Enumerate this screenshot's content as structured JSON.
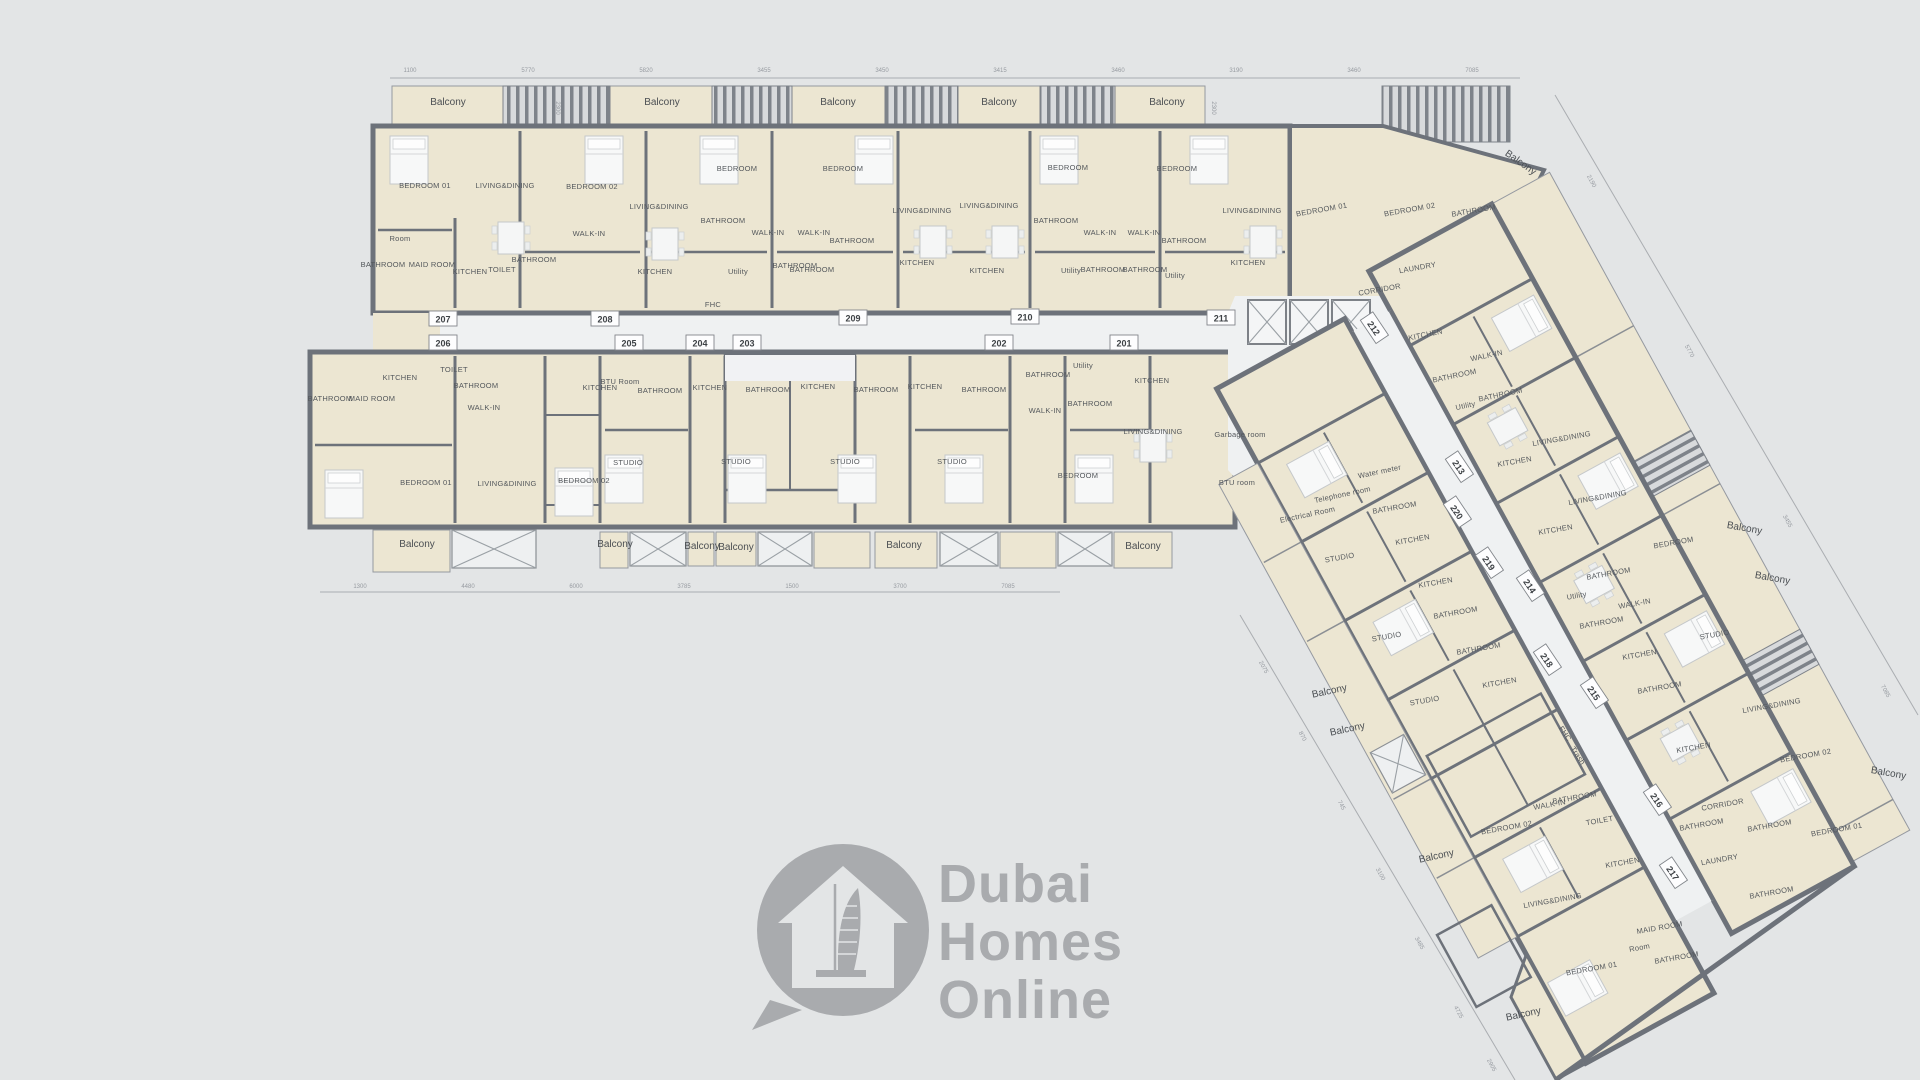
{
  "background": "#e3e5e6",
  "palette": {
    "wall": "#6d727a",
    "unit_fill": "#ece6d2",
    "common_fill": "#eff1f2",
    "hatch_bar": "#7e838a",
    "room_label": "#54585c",
    "dimension_label": "#979ba1",
    "watermark_gray": "#a9abae"
  },
  "watermark": {
    "lines": [
      "Dubai",
      "Homes",
      "Online"
    ],
    "icon": "house-with-burj-al-arab-in-speech-bubble"
  },
  "unit_tags": {
    "top_row": [
      {
        "num": "207",
        "x": 443,
        "y": 319
      },
      {
        "num": "208",
        "x": 605,
        "y": 319
      },
      {
        "num": "209",
        "x": 853,
        "y": 318
      },
      {
        "num": "210",
        "x": 1025,
        "y": 317
      },
      {
        "num": "211",
        "x": 1221,
        "y": 318
      }
    ],
    "bottom_row": [
      {
        "num": "206",
        "x": 443,
        "y": 343
      },
      {
        "num": "205",
        "x": 629,
        "y": 343
      },
      {
        "num": "204",
        "x": 700,
        "y": 343
      },
      {
        "num": "203",
        "x": 747,
        "y": 343
      },
      {
        "num": "202",
        "x": 999,
        "y": 343
      },
      {
        "num": "201",
        "x": 1124,
        "y": 343
      }
    ],
    "wing": [
      {
        "num": "212",
        "x": 1374,
        "y": 328,
        "r": 56
      },
      {
        "num": "213",
        "x": 1459,
        "y": 467,
        "r": 56
      },
      {
        "num": "220",
        "x": 1457,
        "y": 512,
        "r": 56
      },
      {
        "num": "219",
        "x": 1489,
        "y": 563,
        "r": 56
      },
      {
        "num": "214",
        "x": 1530,
        "y": 586,
        "r": 56
      },
      {
        "num": "218",
        "x": 1547,
        "y": 660,
        "r": 56
      },
      {
        "num": "215",
        "x": 1594,
        "y": 693,
        "r": 56
      },
      {
        "num": "216",
        "x": 1657,
        "y": 800,
        "r": 56
      },
      {
        "num": "217",
        "x": 1673,
        "y": 873,
        "r": 56
      }
    ]
  },
  "rooms": [
    {
      "t": "BEDROOM 01",
      "x": 425,
      "y": 188
    },
    {
      "t": "LIVING&DINING",
      "x": 505,
      "y": 188
    },
    {
      "t": "BEDROOM 02",
      "x": 592,
      "y": 189
    },
    {
      "t": "Room",
      "x": 400,
      "y": 241
    },
    {
      "t": "BATHROOM",
      "x": 383,
      "y": 267
    },
    {
      "t": "MAID ROOM",
      "x": 432,
      "y": 267
    },
    {
      "t": "KITCHEN",
      "x": 470,
      "y": 274
    },
    {
      "t": "TOILET",
      "x": 502,
      "y": 272
    },
    {
      "t": "BATHROOM",
      "x": 534,
      "y": 262
    },
    {
      "t": "WALK-IN",
      "x": 589,
      "y": 236
    },
    {
      "t": "BEDROOM",
      "x": 737,
      "y": 171
    },
    {
      "t": "LIVING&DINING",
      "x": 659,
      "y": 209
    },
    {
      "t": "BATHROOM",
      "x": 723,
      "y": 223
    },
    {
      "t": "WALK-IN",
      "x": 768,
      "y": 235
    },
    {
      "t": "KITCHEN",
      "x": 655,
      "y": 274
    },
    {
      "t": "Utility",
      "x": 738,
      "y": 274
    },
    {
      "t": "BATHROOM",
      "x": 795,
      "y": 268
    },
    {
      "t": "BEDROOM",
      "x": 843,
      "y": 171
    },
    {
      "t": "LIVING&DINING",
      "x": 922,
      "y": 213
    },
    {
      "t": "WALK-IN",
      "x": 814,
      "y": 235
    },
    {
      "t": "BATHROOM",
      "x": 852,
      "y": 243
    },
    {
      "t": "BATHROOM",
      "x": 812,
      "y": 272
    },
    {
      "t": "KITCHEN",
      "x": 917,
      "y": 265
    },
    {
      "t": "BEDROOM",
      "x": 1068,
      "y": 170
    },
    {
      "t": "LIVING&DINING",
      "x": 989,
      "y": 208
    },
    {
      "t": "BATHROOM",
      "x": 1056,
      "y": 223
    },
    {
      "t": "WALK-IN",
      "x": 1100,
      "y": 235
    },
    {
      "t": "KITCHEN",
      "x": 987,
      "y": 273
    },
    {
      "t": "Utility",
      "x": 1071,
      "y": 273
    },
    {
      "t": "BATHROOM",
      "x": 1103,
      "y": 272
    },
    {
      "t": "BEDROOM",
      "x": 1177,
      "y": 171
    },
    {
      "t": "LIVING&DINING",
      "x": 1252,
      "y": 213
    },
    {
      "t": "WALK-IN",
      "x": 1144,
      "y": 235
    },
    {
      "t": "BATHROOM",
      "x": 1184,
      "y": 243
    },
    {
      "t": "BATHROOM",
      "x": 1145,
      "y": 272
    },
    {
      "t": "Utility",
      "x": 1175,
      "y": 278
    },
    {
      "t": "KITCHEN",
      "x": 1248,
      "y": 265
    },
    {
      "t": "BEDROOM 01",
      "x": 1322,
      "y": 212,
      "r": -10
    },
    {
      "t": "BEDROOM 02",
      "x": 1410,
      "y": 212,
      "r": -10
    },
    {
      "t": "BATHROOM",
      "x": 1474,
      "y": 213,
      "r": -10
    },
    {
      "t": "LAUNDRY",
      "x": 1418,
      "y": 270,
      "r": -10
    },
    {
      "t": "CORRIDOR",
      "x": 1380,
      "y": 292,
      "r": -10
    },
    {
      "t": "BATHROOM",
      "x": 330,
      "y": 401
    },
    {
      "t": "MAID ROOM",
      "x": 372,
      "y": 401
    },
    {
      "t": "KITCHEN",
      "x": 400,
      "y": 380
    },
    {
      "t": "TOILET",
      "x": 454,
      "y": 372
    },
    {
      "t": "BATHROOM",
      "x": 476,
      "y": 388
    },
    {
      "t": "WALK-IN",
      "x": 484,
      "y": 410
    },
    {
      "t": "BEDROOM 01",
      "x": 426,
      "y": 485
    },
    {
      "t": "LIVING&DINING",
      "x": 507,
      "y": 486
    },
    {
      "t": "BEDROOM 02",
      "x": 584,
      "y": 483
    },
    {
      "t": "STUDIO",
      "x": 628,
      "y": 465
    },
    {
      "t": "KITCHEN",
      "x": 600,
      "y": 390
    },
    {
      "t": "BATHROOM",
      "x": 660,
      "y": 393
    },
    {
      "t": "STUDIO",
      "x": 736,
      "y": 464
    },
    {
      "t": "KITCHEN",
      "x": 710,
      "y": 390
    },
    {
      "t": "BATHROOM",
      "x": 768,
      "y": 392
    },
    {
      "t": "STUDIO",
      "x": 845,
      "y": 464
    },
    {
      "t": "KITCHEN",
      "x": 818,
      "y": 389
    },
    {
      "t": "BATHROOM",
      "x": 876,
      "y": 392
    },
    {
      "t": "STUDIO",
      "x": 952,
      "y": 464
    },
    {
      "t": "KITCHEN",
      "x": 925,
      "y": 389
    },
    {
      "t": "BATHROOM",
      "x": 984,
      "y": 392
    },
    {
      "t": "BATHROOM",
      "x": 1048,
      "y": 377
    },
    {
      "t": "Utility",
      "x": 1083,
      "y": 368
    },
    {
      "t": "WALK-IN",
      "x": 1045,
      "y": 413
    },
    {
      "t": "BATHROOM",
      "x": 1090,
      "y": 406
    },
    {
      "t": "KITCHEN",
      "x": 1152,
      "y": 383
    },
    {
      "t": "LIVING&DINING",
      "x": 1153,
      "y": 434
    },
    {
      "t": "BEDROOM",
      "x": 1078,
      "y": 478
    },
    {
      "t": "KITCHEN",
      "x": 1426,
      "y": 337,
      "r": -12
    },
    {
      "t": "WALK-IN",
      "x": 1487,
      "y": 358,
      "r": -12
    },
    {
      "t": "BATHROOM",
      "x": 1455,
      "y": 378,
      "r": -12
    },
    {
      "t": "BATHROOM",
      "x": 1501,
      "y": 397,
      "r": -12
    },
    {
      "t": "Utility",
      "x": 1466,
      "y": 408,
      "r": -12
    },
    {
      "t": "LIVING&DINING",
      "x": 1562,
      "y": 441,
      "r": -10
    },
    {
      "t": "KITCHEN",
      "x": 1515,
      "y": 464,
      "r": -10
    },
    {
      "t": "LIVING&DINING",
      "x": 1598,
      "y": 500,
      "r": -10
    },
    {
      "t": "KITCHEN",
      "x": 1556,
      "y": 532,
      "r": -10
    },
    {
      "t": "BEDROOM",
      "x": 1674,
      "y": 545,
      "r": -10
    },
    {
      "t": "BATHROOM",
      "x": 1609,
      "y": 576,
      "r": -10
    },
    {
      "t": "Utility",
      "x": 1577,
      "y": 598,
      "r": -10
    },
    {
      "t": "WALK-IN",
      "x": 1635,
      "y": 606,
      "r": -10
    },
    {
      "t": "BATHROOM",
      "x": 1602,
      "y": 625,
      "r": -10
    },
    {
      "t": "BATHROOM",
      "x": 1395,
      "y": 510,
      "r": -10
    },
    {
      "t": "KITCHEN",
      "x": 1413,
      "y": 542,
      "r": -10
    },
    {
      "t": "STUDIO",
      "x": 1340,
      "y": 560,
      "r": -10
    },
    {
      "t": "KITCHEN",
      "x": 1436,
      "y": 585,
      "r": -10
    },
    {
      "t": "BATHROOM",
      "x": 1456,
      "y": 615,
      "r": -10
    },
    {
      "t": "STUDIO",
      "x": 1387,
      "y": 639,
      "r": -10
    },
    {
      "t": "BATHROOM",
      "x": 1479,
      "y": 651,
      "r": -10
    },
    {
      "t": "KITCHEN",
      "x": 1500,
      "y": 685,
      "r": -10
    },
    {
      "t": "STUDIO",
      "x": 1425,
      "y": 703,
      "r": -10
    },
    {
      "t": "STUDIO",
      "x": 1715,
      "y": 637,
      "r": -10
    },
    {
      "t": "KITCHEN",
      "x": 1640,
      "y": 657,
      "r": -10
    },
    {
      "t": "BATHROOM",
      "x": 1660,
      "y": 690,
      "r": -10
    },
    {
      "t": "KITCHEN",
      "x": 1694,
      "y": 750,
      "r": -10
    },
    {
      "t": "LIVING&DINING",
      "x": 1772,
      "y": 708,
      "r": -10
    },
    {
      "t": "BEDROOM 02",
      "x": 1806,
      "y": 758,
      "r": -10
    },
    {
      "t": "CORRIDOR",
      "x": 1723,
      "y": 807,
      "r": -10
    },
    {
      "t": "BATHROOM",
      "x": 1702,
      "y": 827,
      "r": -10
    },
    {
      "t": "BATHROOM",
      "x": 1770,
      "y": 828,
      "r": -10
    },
    {
      "t": "LAUNDRY",
      "x": 1720,
      "y": 862,
      "r": -10
    },
    {
      "t": "BEDROOM 01",
      "x": 1837,
      "y": 832,
      "r": -10
    },
    {
      "t": "BATHROOM",
      "x": 1772,
      "y": 895,
      "r": -10
    },
    {
      "t": "BEDROOM 02",
      "x": 1507,
      "y": 830,
      "r": -10
    },
    {
      "t": "WALK-IN",
      "x": 1550,
      "y": 807,
      "r": -10
    },
    {
      "t": "BATHROOM",
      "x": 1575,
      "y": 800,
      "r": -10
    },
    {
      "t": "TOILET",
      "x": 1600,
      "y": 823,
      "r": -10
    },
    {
      "t": "KITCHEN",
      "x": 1623,
      "y": 865,
      "r": -10
    },
    {
      "t": "LIVING&DINING",
      "x": 1553,
      "y": 903,
      "r": -10
    },
    {
      "t": "BEDROOM 01",
      "x": 1592,
      "y": 971,
      "r": -10
    },
    {
      "t": "MAID ROOM",
      "x": 1660,
      "y": 930,
      "r": -10
    },
    {
      "t": "BATHROOM",
      "x": 1677,
      "y": 960,
      "r": -10
    },
    {
      "t": "Room",
      "x": 1640,
      "y": 950,
      "r": -10
    }
  ],
  "balconies": [
    {
      "t": "Balcony",
      "x": 448,
      "y": 105
    },
    {
      "t": "Balcony",
      "x": 662,
      "y": 105
    },
    {
      "t": "Balcony",
      "x": 838,
      "y": 105
    },
    {
      "t": "Balcony",
      "x": 999,
      "y": 105
    },
    {
      "t": "Balcony",
      "x": 1167,
      "y": 105
    },
    {
      "t": "Balcony",
      "x": 1519,
      "y": 165,
      "r": 35
    },
    {
      "t": "Balcony",
      "x": 1744,
      "y": 531,
      "r": 10
    },
    {
      "t": "Balcony",
      "x": 1772,
      "y": 581,
      "r": 10
    },
    {
      "t": "Balcony",
      "x": 1888,
      "y": 776,
      "r": 10
    },
    {
      "t": "Balcony",
      "x": 1330,
      "y": 694,
      "r": -12
    },
    {
      "t": "Balcony",
      "x": 1348,
      "y": 732,
      "r": -12
    },
    {
      "t": "Balcony",
      "x": 1437,
      "y": 859,
      "r": -12
    },
    {
      "t": "Balcony",
      "x": 1524,
      "y": 1017,
      "r": -12
    },
    {
      "t": "Balcony",
      "x": 417,
      "y": 547
    },
    {
      "t": "Balcony",
      "x": 615,
      "y": 547
    },
    {
      "t": "Balcony",
      "x": 702,
      "y": 549
    },
    {
      "t": "Balcony",
      "x": 736,
      "y": 550
    },
    {
      "t": "Balcony",
      "x": 904,
      "y": 548
    },
    {
      "t": "Balcony",
      "x": 1143,
      "y": 549
    }
  ],
  "services": [
    {
      "t": "BTU Room",
      "x": 620,
      "y": 384
    },
    {
      "t": "FHC",
      "x": 713,
      "y": 307
    },
    {
      "t": "Garbage room",
      "x": 1240,
      "y": 437
    },
    {
      "t": "BTU room",
      "x": 1237,
      "y": 485
    },
    {
      "t": "Electrical Room",
      "x": 1308,
      "y": 517,
      "r": -12
    },
    {
      "t": "Telephone room",
      "x": 1343,
      "y": 497,
      "r": -12
    },
    {
      "t": "Water meter",
      "x": 1380,
      "y": 474,
      "r": -12
    },
    {
      "t": "FHC",
      "x": 1563,
      "y": 735,
      "r": 56
    },
    {
      "t": "Trash",
      "x": 1576,
      "y": 757,
      "r": 56
    }
  ],
  "dimensions": {
    "top": [
      {
        "v": "1100",
        "x": 410,
        "y": 72
      },
      {
        "v": "5770",
        "x": 528,
        "y": 72
      },
      {
        "v": "5820",
        "x": 646,
        "y": 72
      },
      {
        "v": "3455",
        "x": 764,
        "y": 72
      },
      {
        "v": "3450",
        "x": 882,
        "y": 72
      },
      {
        "v": "3415",
        "x": 1000,
        "y": 72
      },
      {
        "v": "3460",
        "x": 1118,
        "y": 72
      },
      {
        "v": "3190",
        "x": 1236,
        "y": 72
      },
      {
        "v": "3460",
        "x": 1354,
        "y": 72
      },
      {
        "v": "7085",
        "x": 1472,
        "y": 72
      }
    ],
    "bottom": [
      {
        "v": "1300",
        "x": 360,
        "y": 588
      },
      {
        "v": "4480",
        "x": 468,
        "y": 588
      },
      {
        "v": "6000",
        "x": 576,
        "y": 588
      },
      {
        "v": "3785",
        "x": 684,
        "y": 588
      },
      {
        "v": "1500",
        "x": 792,
        "y": 588
      },
      {
        "v": "3700",
        "x": 900,
        "y": 588
      },
      {
        "v": "7085",
        "x": 1008,
        "y": 588
      }
    ],
    "diagonal_sw": [
      {
        "v": "2075",
        "x": 1262,
        "y": 668,
        "r": 61
      },
      {
        "v": "870",
        "x": 1301,
        "y": 737,
        "r": 61
      },
      {
        "v": "745",
        "x": 1340,
        "y": 806,
        "r": 61
      },
      {
        "v": "3100",
        "x": 1379,
        "y": 875,
        "r": 61
      },
      {
        "v": "3485",
        "x": 1418,
        "y": 944,
        "r": 61
      },
      {
        "v": "4725",
        "x": 1457,
        "y": 1013,
        "r": 61
      },
      {
        "v": "2905",
        "x": 1490,
        "y": 1066,
        "r": 61
      }
    ],
    "diagonal_ne": [
      {
        "v": "2190",
        "x": 1590,
        "y": 182,
        "r": 61
      },
      {
        "v": "5770",
        "x": 1688,
        "y": 352,
        "r": 61
      },
      {
        "v": "3455",
        "x": 1786,
        "y": 522,
        "r": 61
      },
      {
        "v": "7085",
        "x": 1884,
        "y": 692,
        "r": 61
      }
    ],
    "balcony_depths": [
      {
        "v": "2300",
        "x": 556,
        "y": 108,
        "r": 90
      },
      {
        "v": "2300",
        "x": 1212,
        "y": 108,
        "r": 90
      }
    ]
  }
}
